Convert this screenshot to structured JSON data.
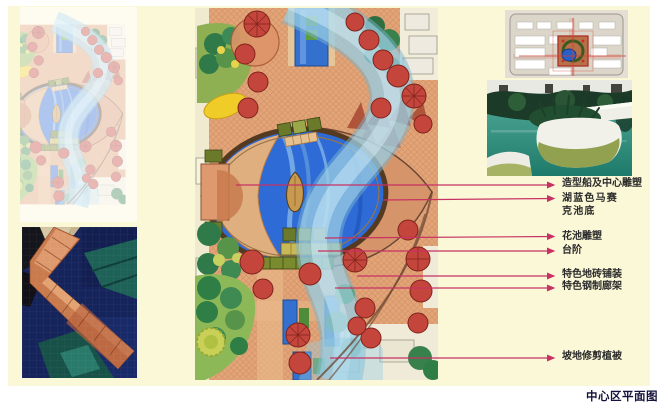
{
  "page": {
    "title_label": "中心区平面图",
    "panel_bg": "#FBF8D8",
    "leader_color": "#C73263"
  },
  "annotations": [
    {
      "text": "造型船及中心雕塑"
    },
    {
      "text": "湖蓝色马赛\n克池底"
    },
    {
      "text": "花池雕塑"
    },
    {
      "text": "台阶"
    },
    {
      "text": "特色地砖铺装"
    },
    {
      "text": "特色钢制廊架"
    },
    {
      "text": "坡地修剪植被"
    }
  ],
  "figures": {
    "faded_plan": "faded-master-plan-thumbnail",
    "pool_edge_photo": "tiled-pool-edge-photo",
    "main_plan": "central-area-landscape-plan",
    "site_plan": "site-location-plan-thumbnail",
    "planter_photo": "planter-pool-photo"
  }
}
